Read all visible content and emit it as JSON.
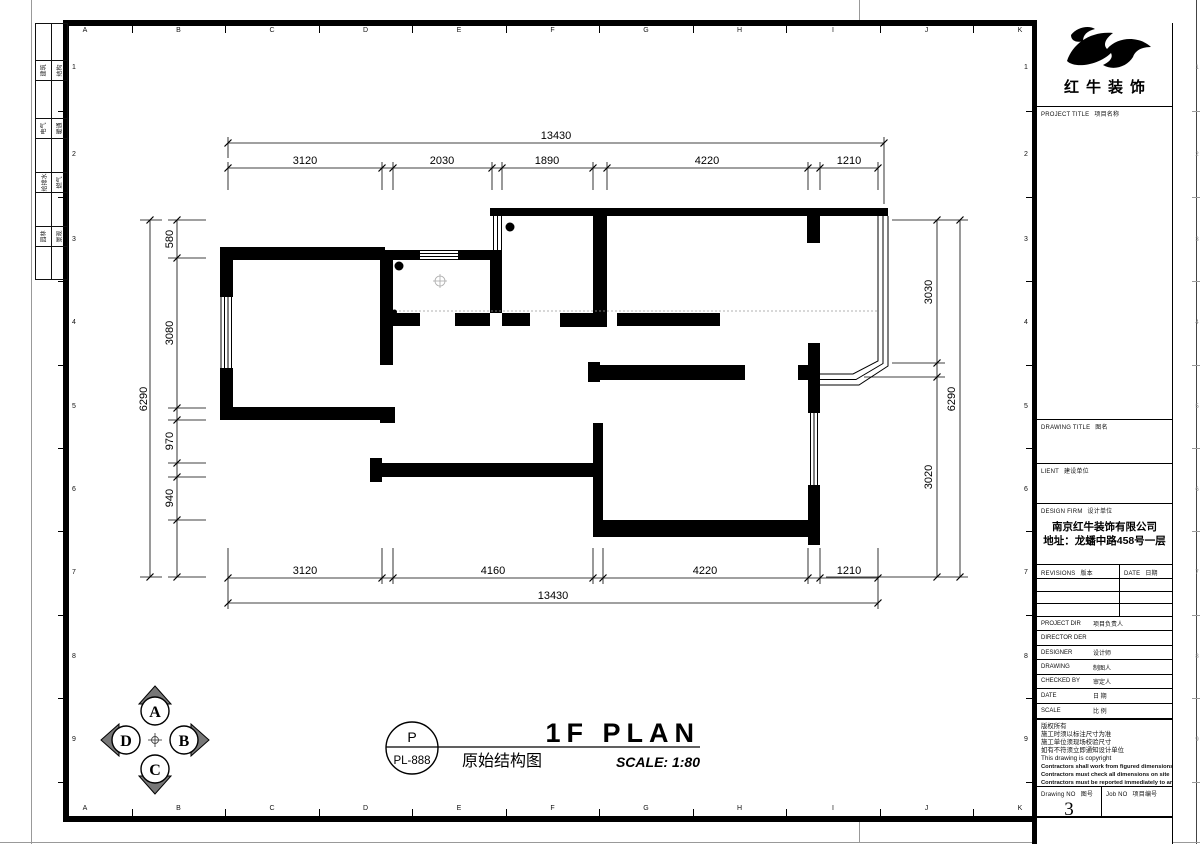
{
  "frame": {
    "grid_columns": [
      "A",
      "B",
      "C",
      "D",
      "E",
      "F",
      "G",
      "H",
      "I",
      "J",
      "K"
    ],
    "grid_rows": [
      "1",
      "2",
      "3",
      "4",
      "5",
      "6",
      "7",
      "8",
      "9"
    ],
    "signoff_rows": [
      [
        "建筑",
        "结构"
      ],
      [
        "电气",
        "暖通"
      ],
      [
        "给排水",
        "燃气"
      ],
      [
        "园林",
        "景观"
      ]
    ]
  },
  "plan": {
    "dims": {
      "top_overall": "13430",
      "top_chain": [
        "3120",
        "2030",
        "1890",
        "4220",
        "1210"
      ],
      "bottom_chain": [
        "3120",
        "4160",
        "4220",
        "1210"
      ],
      "bottom_overall": "13430",
      "left_chain": [
        "580",
        "3080",
        "970",
        "940"
      ],
      "left_overall": "6290",
      "right_chain": [
        "3030",
        "3020"
      ],
      "right_overall": "6290"
    }
  },
  "sheet": {
    "compass_letters": [
      "A",
      "B",
      "C",
      "D"
    ],
    "badge_letter": "P",
    "badge_code": "PL-888",
    "title_cn": "原始结构图",
    "title_en": "1F PLAN",
    "scale_note": "SCALE: 1:80"
  },
  "title_block": {
    "brand": "红牛装饰",
    "project_title": {
      "en": "PROJECT TITLE",
      "cn": "项目名称"
    },
    "drawing_title": {
      "en": "DRAWING TITLE",
      "cn": "图名"
    },
    "client": {
      "en": "LIENT",
      "cn": "建设单位"
    },
    "design_firm": {
      "en": "DESIGN FIRM",
      "cn": "设计单位"
    },
    "firm_name": "南京红牛装饰有限公司",
    "firm_address": "地址：龙蟠中路458号一层",
    "revisions": {
      "en": "REVISIONS",
      "cn": "版本"
    },
    "date_col": {
      "en": "DATE",
      "cn": "日期"
    },
    "fields": [
      {
        "en": "PROJECT DIR",
        "cn": "项目负责人"
      },
      {
        "en": "DIRECTOR DER",
        "cn": ""
      },
      {
        "en": "DESIGNER",
        "cn": "设计师"
      },
      {
        "en": "DRAWING",
        "cn": "制图人"
      },
      {
        "en": "CHECKED BY",
        "cn": "审定人"
      },
      {
        "en": "DATE",
        "cn": "日 期"
      },
      {
        "en": "SCALE",
        "cn": "比 例"
      }
    ],
    "notes": [
      {
        "text": "版权所有",
        "bold": false
      },
      {
        "text": "施工时须以标注尺寸为准",
        "bold": false
      },
      {
        "text": "施工单位须现场校验尺寸",
        "bold": false
      },
      {
        "text": "如有不符须立即通知设计单位",
        "bold": false
      },
      {
        "text": "This drawing is copyright",
        "bold": false
      },
      {
        "text": "Contractors shall work from figured dimensions only",
        "bold": true
      },
      {
        "text": "Contractors must check all dimensions on site",
        "bold": true
      },
      {
        "text": "Contractors must be reported immediately to architects",
        "bold": true
      }
    ],
    "drawing_no": {
      "en": "Drawing NO",
      "cn": "图号",
      "value": "3"
    },
    "job_no": {
      "en": "Job NO",
      "cn": "项目编号"
    }
  }
}
